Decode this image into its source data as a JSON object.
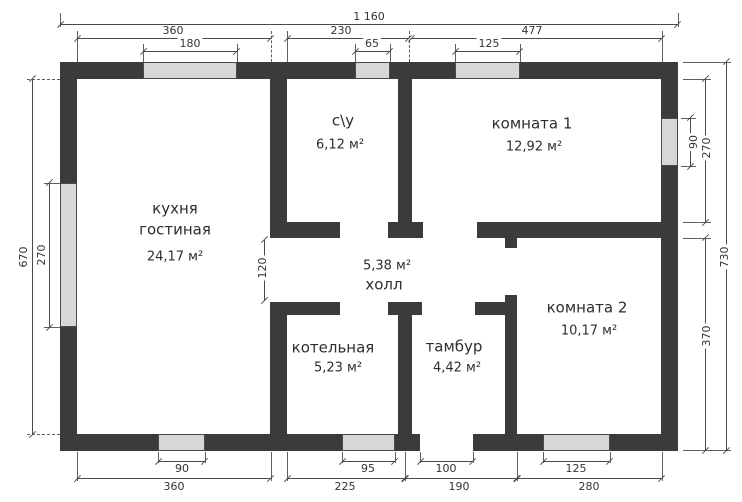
{
  "drawing": {
    "type": "house-floor-plan",
    "units": "cm",
    "colors": {
      "wall": "#3b3b3b",
      "window_fill": "#d7d7d7",
      "dimension_lines": "#4a4a4a",
      "background": "#ffffff"
    }
  },
  "rooms": {
    "kitchen": {
      "name1": "кухня",
      "name2": "гостиная",
      "area": "24,17 м²"
    },
    "bathroom": {
      "name": "с\\у",
      "area": "6,12 м²"
    },
    "room1": {
      "name": "комната 1",
      "area": "12,92 м²"
    },
    "hall": {
      "name": "холл",
      "area": "5,38 м²"
    },
    "boiler": {
      "name": "котельная",
      "area": "5,23 м²"
    },
    "vestibule": {
      "name": "тамбур",
      "area": "4,42 м²"
    },
    "room2": {
      "name": "комната 2",
      "area": "10,17 м²"
    }
  },
  "dims": {
    "top_overall": "1 160",
    "top_kitchen": "360",
    "top_bathroom": "230",
    "top_room1": "477",
    "top_kitchen_window": "180",
    "top_bathroom_window": "65",
    "top_room1_window": "125",
    "bottom_kitchen_window": "90",
    "bottom_kitchen": "360",
    "bottom_boiler_window": "95",
    "bottom_boiler": "225",
    "bottom_entrance": "100",
    "bottom_vestibule": "190",
    "bottom_room2_window": "125",
    "bottom_room2": "280",
    "left_height": "670",
    "left_window": "270",
    "right_window": "90",
    "right_room1": "270",
    "right_room2": "370",
    "right_overall": "730",
    "hall_width": "120"
  }
}
